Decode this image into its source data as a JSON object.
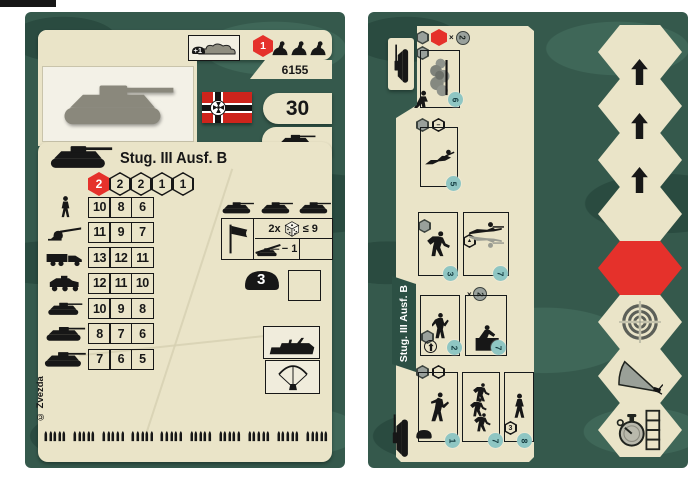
{
  "colors": {
    "panel_green": "#35594c",
    "camo_dark": "#2a4b40",
    "camo_light": "#3f6758",
    "card_cream": "#eae4c8",
    "accent_red": "#e5312b",
    "ink": "#171717",
    "badge_teal": "#8fc6c3",
    "flag_red": "#ce241c"
  },
  "left_card": {
    "product_code": "6155",
    "point_value": "30",
    "unit_title": "Stug. III Ausf. B",
    "camouflage_bonus": "+1",
    "squad_hex_value": "1",
    "strength_hexes": [
      {
        "value": "2",
        "red": true
      },
      {
        "value": "2",
        "red": false
      },
      {
        "value": "2",
        "red": false
      },
      {
        "value": "1",
        "red": false
      },
      {
        "value": "1",
        "red": false
      }
    ],
    "attack_table": [
      {
        "target": "infantry-icon",
        "values": [
          "10",
          "8",
          "6"
        ]
      },
      {
        "target": "at-gun-icon",
        "values": [
          "11",
          "9",
          "7"
        ]
      },
      {
        "target": "truck-icon",
        "values": [
          "13",
          "12",
          "11"
        ]
      },
      {
        "target": "halftrack-icon",
        "values": [
          "12",
          "11",
          "10"
        ]
      },
      {
        "target": "light-tank-icon",
        "values": [
          "10",
          "9",
          "8"
        ]
      },
      {
        "target": "medium-tank-icon",
        "values": [
          "8",
          "7",
          "6"
        ]
      },
      {
        "target": "heavy-tank-icon",
        "values": [
          "7",
          "6",
          "5"
        ]
      }
    ],
    "fire_rule": {
      "multiplier": "2x",
      "threshold": "≤ 9",
      "modifier": "− 1"
    },
    "armor_value": "3",
    "copyright": "© Zvezda",
    "ammo_strip": {
      "groups": 10,
      "per_group": 5
    }
  },
  "right_card": {
    "unit_title": "Stug. III Ausf. B",
    "orders": [
      {
        "name": "smoke-screen",
        "badge": "6",
        "x": "×",
        "multiplier_circle": "2"
      },
      {
        "name": "crawl",
        "badge": "5",
        "hex_glyph": "–"
      },
      {
        "name": "run",
        "badge": "3"
      },
      {
        "name": "fire-prone",
        "badge": "7",
        "hex_glyph": "▲"
      },
      {
        "name": "climb",
        "badge": "2"
      },
      {
        "name": "obstacle-cross",
        "badge": "7",
        "x": "×",
        "multiplier_circle": "2"
      },
      {
        "name": "assault",
        "badge": "1"
      },
      {
        "name": "advance-squad",
        "badge": "7"
      },
      {
        "name": "march",
        "badge": "8",
        "hex_value": "3"
      }
    ],
    "hex_track": [
      {
        "type": "move",
        "arrow": true
      },
      {
        "type": "move",
        "arrow": true
      },
      {
        "type": "move",
        "arrow": true
      },
      {
        "type": "move",
        "arrow": false
      },
      {
        "type": "attack-red",
        "arrow": false
      },
      {
        "type": "target",
        "arrow": false
      },
      {
        "type": "field-of-fire",
        "arrow": false
      },
      {
        "type": "turn-timer",
        "arrow": false
      }
    ]
  }
}
